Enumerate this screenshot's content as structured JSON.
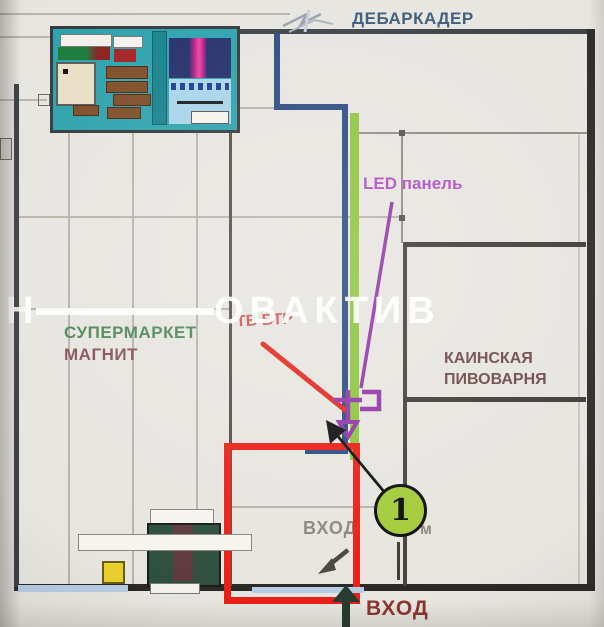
{
  "annotations": {
    "debarkader": "ДЕБАРКАДЕР",
    "led_panel": "LED панель",
    "tv_note": "ТВ ВТР",
    "marker_number": "1",
    "entrance_inner": "ВХОД",
    "entrance_inner_unit": "м",
    "entrance_bottom": "ВХОД"
  },
  "tenants": {
    "supermarket_line1": "СУПЕРМАРКЕТ",
    "supermarket_line2": "МАГНИТ",
    "brewery_line1": "КАИНСКАЯ",
    "brewery_line2": "ПИВОВАРНЯ"
  },
  "watermark": {
    "prefix": "Н",
    "suffix": "ОВАКТИВ"
  },
  "colors": {
    "highlight_red": "#ea1f17",
    "route_blue": "#2c4b80",
    "led_line_green": "#8cc63e",
    "led_purple": "#9b3fae",
    "marker_green": "#a3cb39",
    "wall_dark": "#3c4147"
  }
}
